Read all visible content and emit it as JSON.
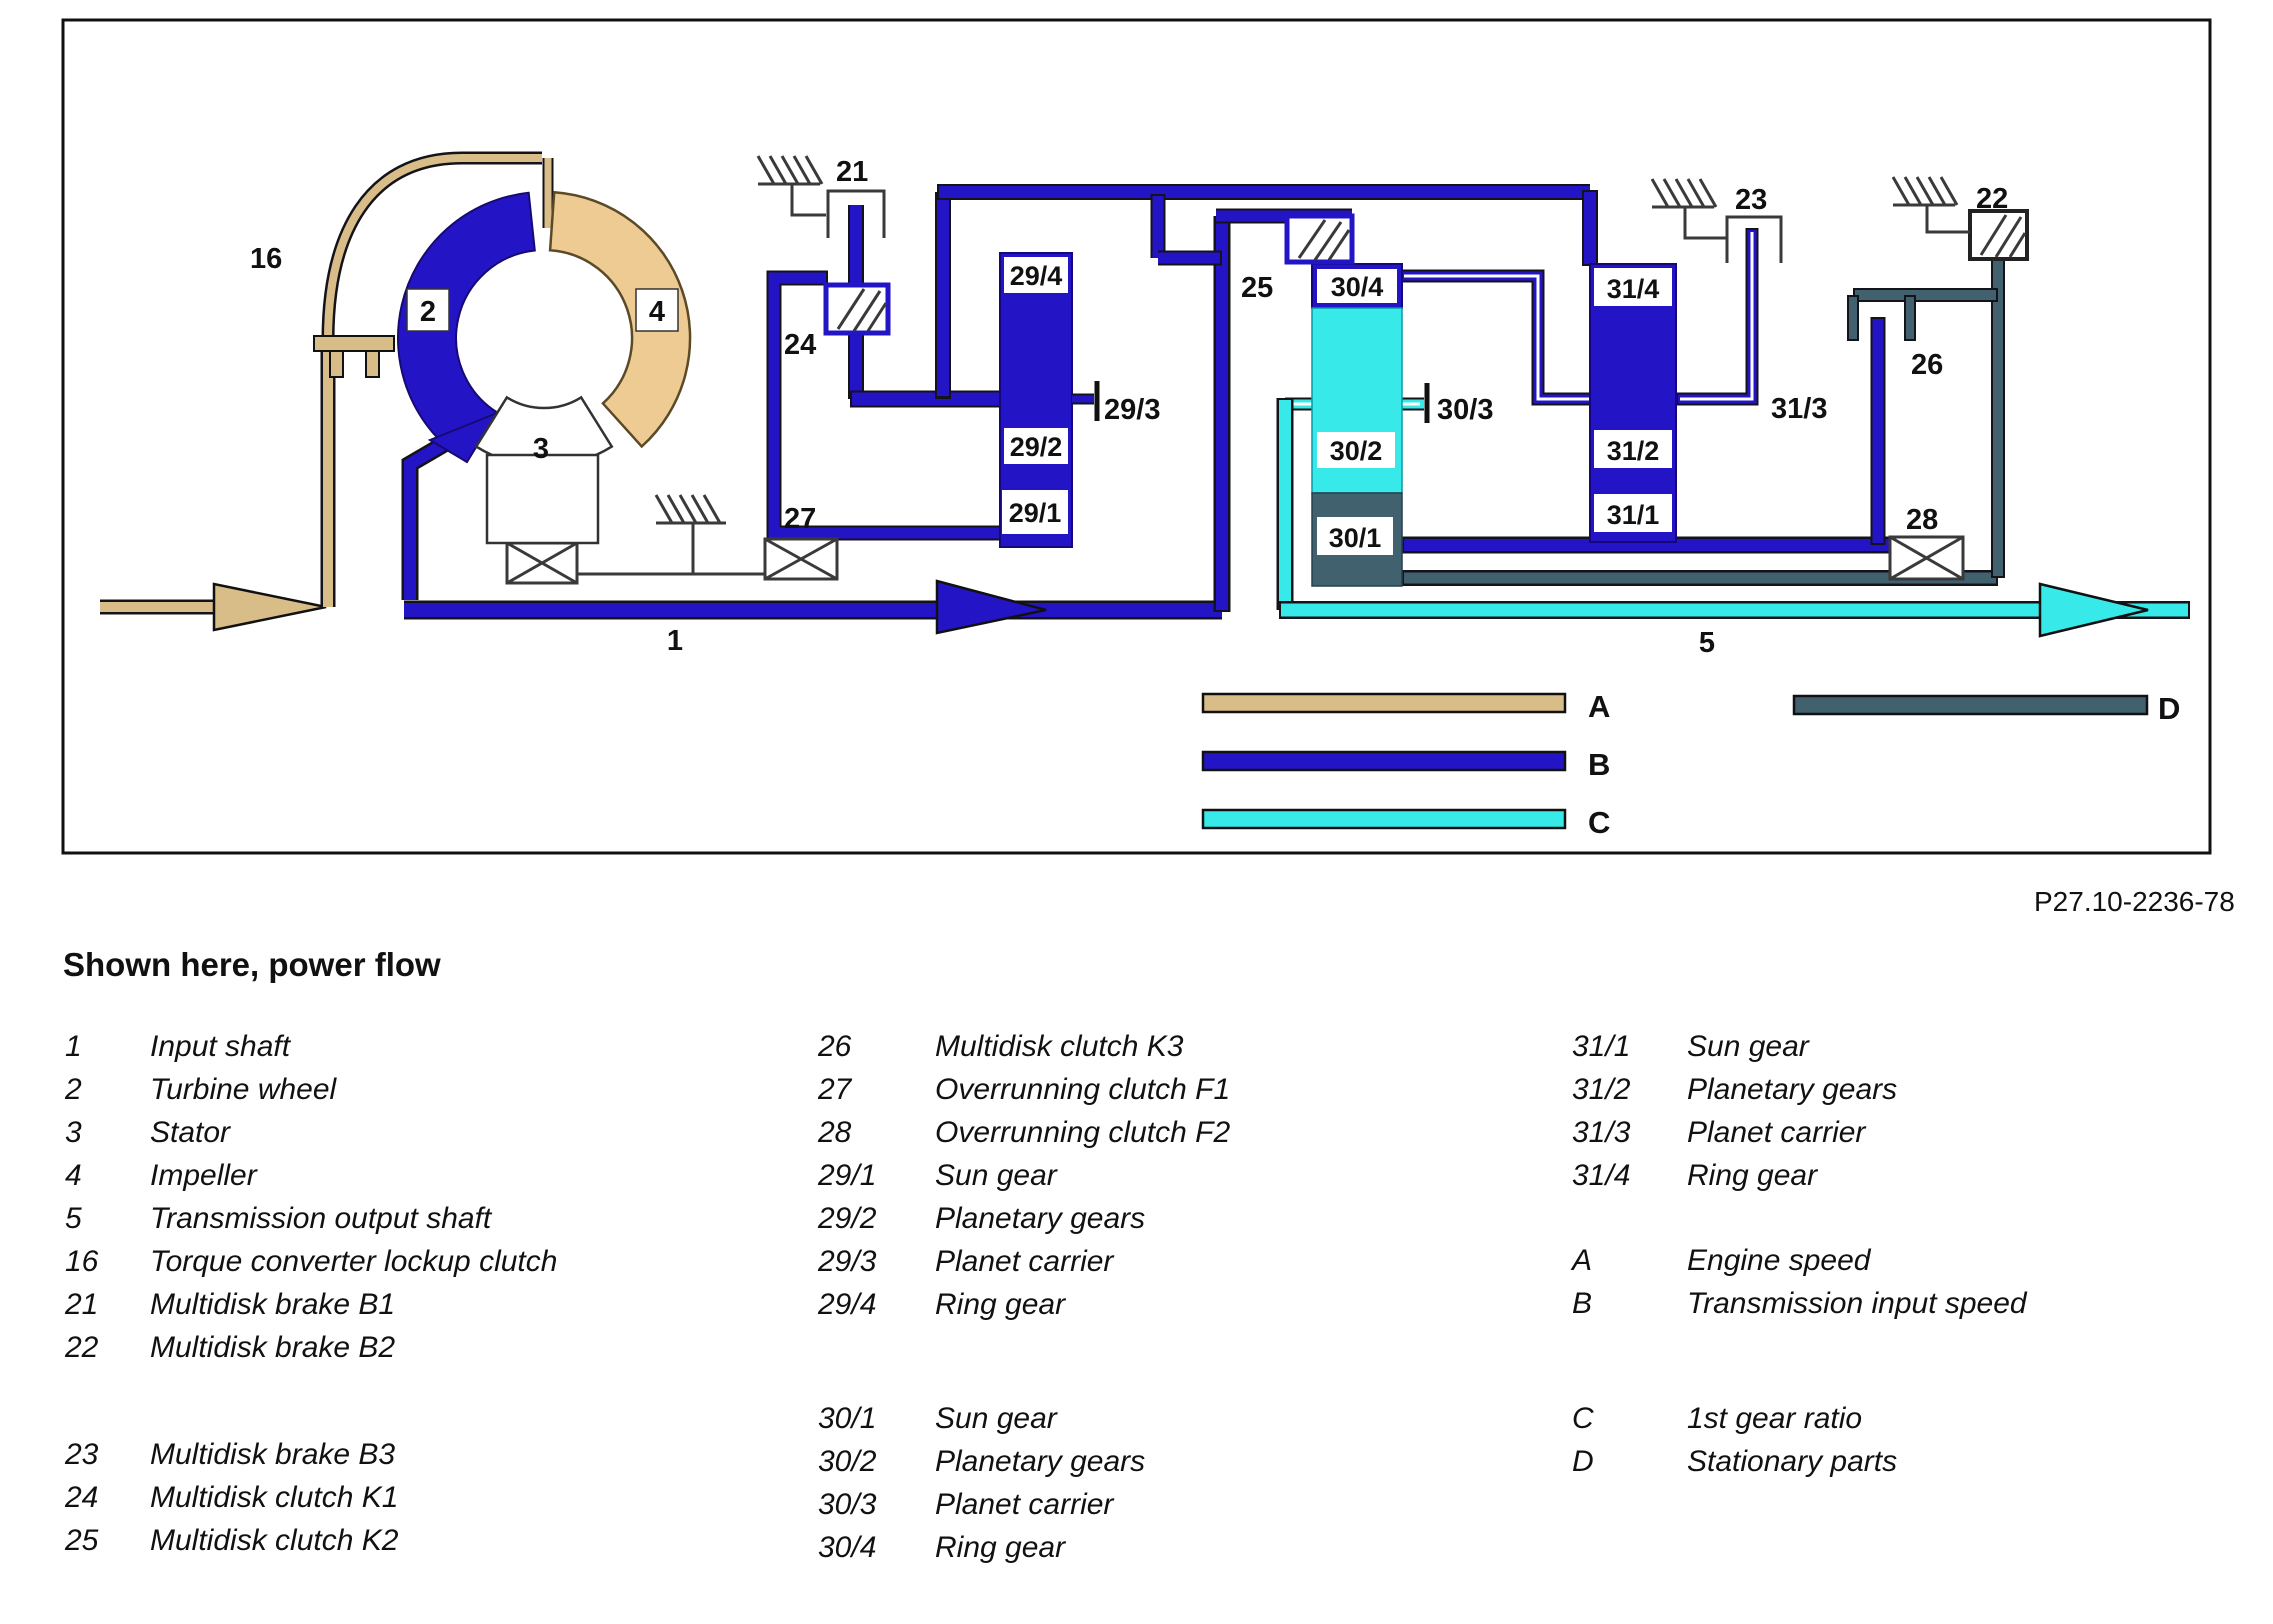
{
  "figure_code": "P27.10-2236-78",
  "title": "Shown here, power flow",
  "colors": {
    "engine_speed_A": "#d9bd88",
    "transmission_input_B": "#2315c6",
    "first_gear_C": "#38e9e9",
    "stationary_D": "#41616f"
  },
  "diagram": {
    "part_labels": {
      "input_shaft": "1",
      "turbine_wheel": "2",
      "stator": "3",
      "impeller": "4",
      "output_shaft": "5",
      "lockup_clutch": "16",
      "brake_b1": "21",
      "brake_b2": "22",
      "brake_b3": "23",
      "clutch_k1": "24",
      "clutch_k2": "25",
      "clutch_k3": "26",
      "overrun_f1": "27",
      "overrun_f2": "28",
      "g29_1": "29/1",
      "g29_2": "29/2",
      "g29_3": "29/3",
      "g29_4": "29/4",
      "g30_1": "30/1",
      "g30_2": "30/2",
      "g30_3": "30/3",
      "g30_4": "30/4",
      "g31_1": "31/1",
      "g31_2": "31/2",
      "g31_3": "31/3",
      "g31_4": "31/4"
    },
    "flow_labels": {
      "A": "A",
      "B": "B",
      "C": "C",
      "D": "D"
    }
  },
  "legend": {
    "col1": [
      {
        "num": "1",
        "text": "Input shaft"
      },
      {
        "num": "2",
        "text": "Turbine wheel"
      },
      {
        "num": "3",
        "text": "Stator"
      },
      {
        "num": "4",
        "text": "Impeller"
      },
      {
        "num": "5",
        "text": "Transmission output shaft"
      },
      {
        "num": "16",
        "text": "Torque converter lockup clutch"
      },
      {
        "num": "21",
        "text": "Multidisk brake B1"
      },
      {
        "num": "22",
        "text": "Multidisk brake B2"
      },
      {
        "num": "23",
        "text": "Multidisk brake B3"
      },
      {
        "num": "24",
        "text": "Multidisk clutch K1"
      },
      {
        "num": "25",
        "text": "Multidisk clutch K2"
      }
    ],
    "col2": [
      {
        "num": "26",
        "text": "Multidisk clutch K3"
      },
      {
        "num": "27",
        "text": "Overrunning clutch F1"
      },
      {
        "num": "28",
        "text": "Overrunning clutch F2"
      },
      {
        "num": "29/1",
        "text": "Sun gear"
      },
      {
        "num": "29/2",
        "text": "Planetary gears"
      },
      {
        "num": "29/3",
        "text": "Planet carrier"
      },
      {
        "num": "29/4",
        "text": "Ring gear"
      },
      {
        "num": "30/1",
        "text": "Sun gear"
      },
      {
        "num": "30/2",
        "text": "Planetary gears"
      },
      {
        "num": "30/3",
        "text": "Planet carrier"
      },
      {
        "num": "30/4",
        "text": "Ring gear"
      }
    ],
    "col3": [
      {
        "num": "31/1",
        "text": "Sun gear"
      },
      {
        "num": "31/2",
        "text": "Planetary gears"
      },
      {
        "num": "31/3",
        "text": "Planet carrier"
      },
      {
        "num": "31/4",
        "text": "Ring gear"
      },
      {
        "num": "A",
        "text": "Engine speed"
      },
      {
        "num": "B",
        "text": "Transmission input speed"
      },
      {
        "num": "C",
        "text": "1st gear ratio"
      },
      {
        "num": "D",
        "text": "Stationary parts"
      }
    ]
  }
}
